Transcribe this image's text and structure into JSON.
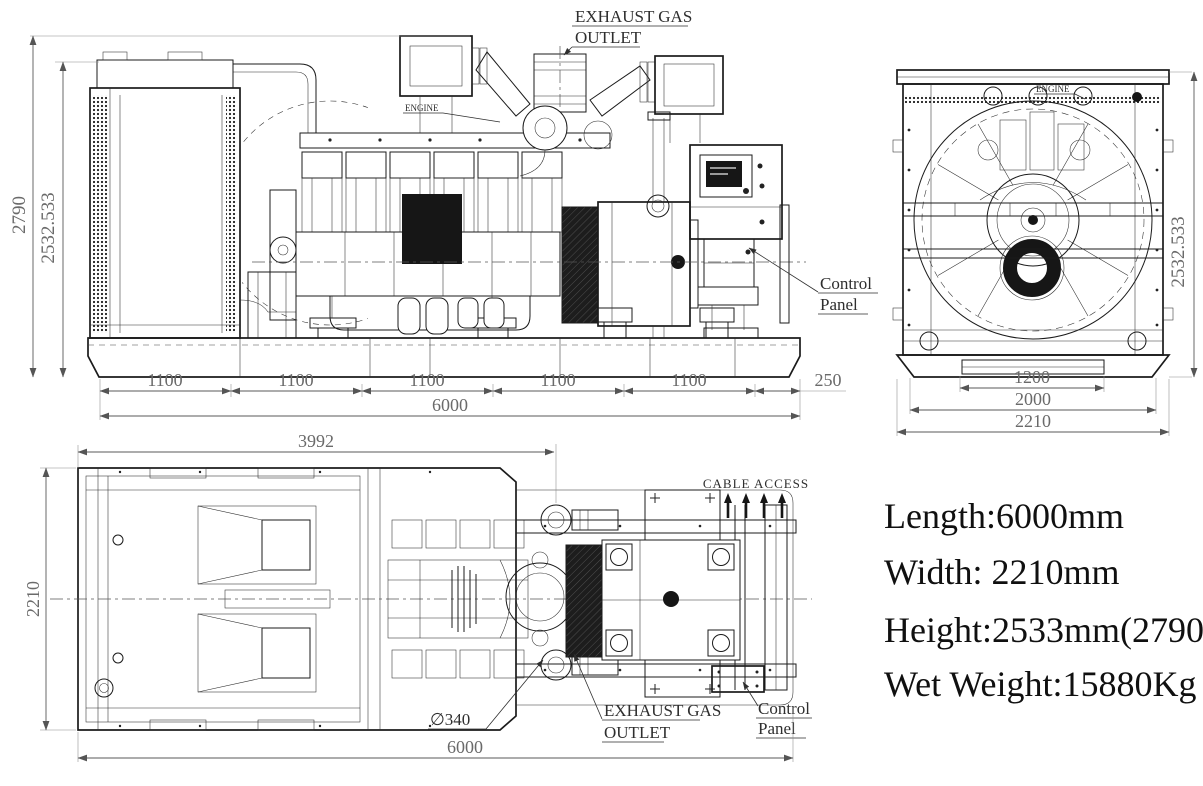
{
  "side_view": {
    "exhaust_label": {
      "line1": "EXHAUST GAS",
      "line2": "OUTLET"
    },
    "engine_label": "ENGINE",
    "control_panel_label": {
      "line1": "Control",
      "line2": "Panel"
    },
    "dim_height_overall": "2790",
    "dim_height_frame": "2532.533",
    "dim_segments": [
      "1100",
      "1100",
      "1100",
      "1100",
      "1100",
      "250"
    ],
    "dim_length": "6000"
  },
  "front_view": {
    "engine_label": "ENGINE",
    "dim_height_frame": "2532.533",
    "dim_base_inner": "1200",
    "dim_base_outer": "2000",
    "dim_width": "2210"
  },
  "plan_view": {
    "dim_partial_length": "3992",
    "dim_width": "2210",
    "dim_length": "6000",
    "exhaust_diameter": "∅340",
    "cable_access_label": "CABLE ACCESS",
    "exhaust_label": {
      "line1": "EXHAUST GAS",
      "line2": "OUTLET"
    },
    "control_panel_label": {
      "line1": "Control",
      "line2": "Panel"
    }
  },
  "specs": {
    "length": "Length:6000mm",
    "width": "Width: 2210mm",
    "height": "Height:2533mm(2790)",
    "wet_weight": "Wet Weight:15880Kg"
  }
}
